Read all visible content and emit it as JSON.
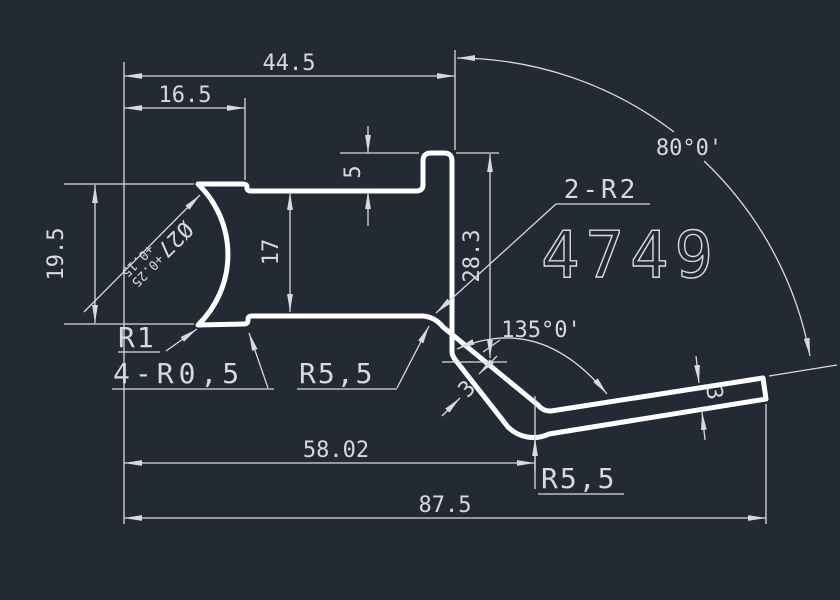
{
  "app": {
    "background": "#242a34",
    "outline_color": "#ffffff",
    "dim_color": "#d6dae0"
  },
  "drawing": {
    "part_number": "4749",
    "linear_dims": {
      "top_width": "44.5",
      "band_width": "16.5",
      "tab_height": "5",
      "mid_height": "17",
      "left_height": "19.5",
      "right_height": "28.3",
      "bend_width": "58.02",
      "overall_width": "87.5"
    },
    "angular_dims": {
      "strip_angle": "80°0'",
      "bend_angle": "135°0'"
    },
    "radius_dims": {
      "tab_corners": "2-R2",
      "arc_fillet": "R1",
      "step_corners": "4-R0,5",
      "inner_fillet": "R5,5",
      "outer_fillet": "R5,5"
    },
    "thickness_dims": {
      "bend_thickness": "3",
      "end_thickness": "3"
    },
    "diameter_dim": {
      "value": "Ø27",
      "tol_upper": "+0.25",
      "tol_lower": "+0.15"
    }
  }
}
